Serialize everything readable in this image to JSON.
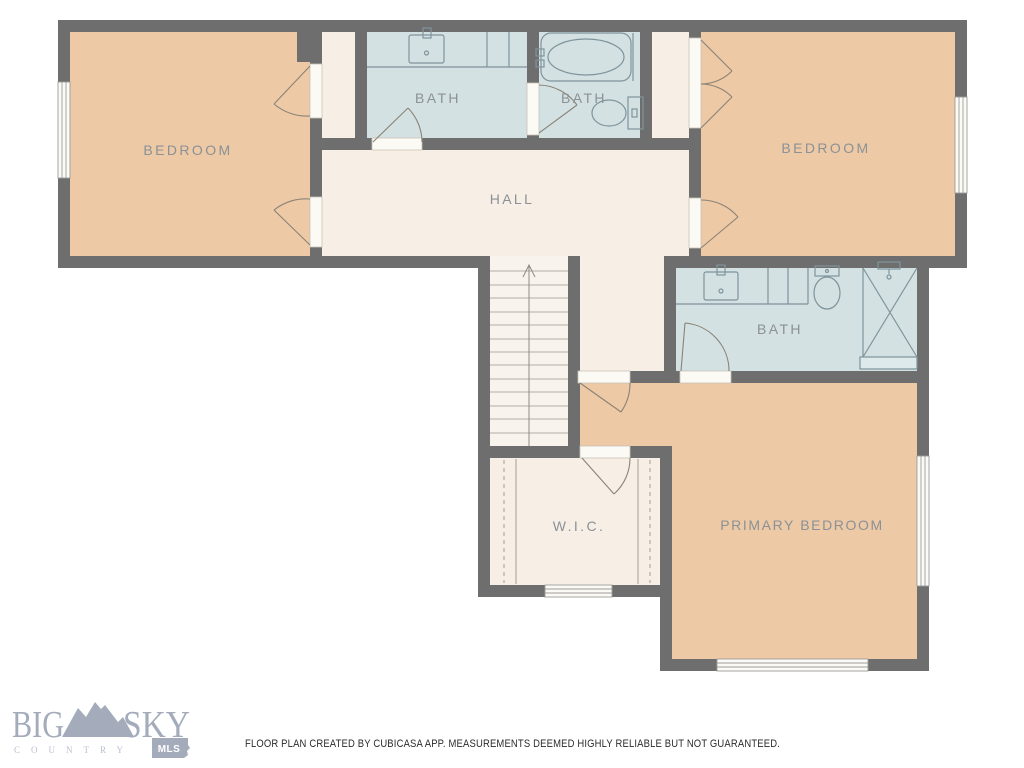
{
  "colors": {
    "wall": "#6e6e6e",
    "bedroom_fill": "#edc9a6",
    "bath_fill": "#d3e1e3",
    "hall_fill": "#f7efe5",
    "stair_fill": "#f8f3ec",
    "fixture_line": "#7e949b",
    "door_line": "#8b8376",
    "label_text": "#8b9196",
    "logo_primary": "#a4acbb",
    "logo_light": "#bac0cd",
    "disclaimer_text": "#2b2b2b"
  },
  "rooms": {
    "bedroom_left": {
      "label": "BEDROOM"
    },
    "bath_upper_left": {
      "label": "BATH"
    },
    "bath_upper_right": {
      "label": "BATH"
    },
    "bedroom_right": {
      "label": "BEDROOM"
    },
    "hall": {
      "label": "HALL"
    },
    "bath_primary": {
      "label": "BATH"
    },
    "wic": {
      "label": "W.I.C."
    },
    "primary_bedroom": {
      "label": "PRIMARY BEDROOM"
    }
  },
  "logo": {
    "word1": "BIG",
    "word2": "SKY",
    "tagline": "COUNTRY",
    "badge": "MLS"
  },
  "footer": {
    "disclaimer": "FLOOR PLAN CREATED BY CUBICASA APP. MEASUREMENTS DEEMED HIGHLY RELIABLE BUT NOT GUARANTEED."
  }
}
